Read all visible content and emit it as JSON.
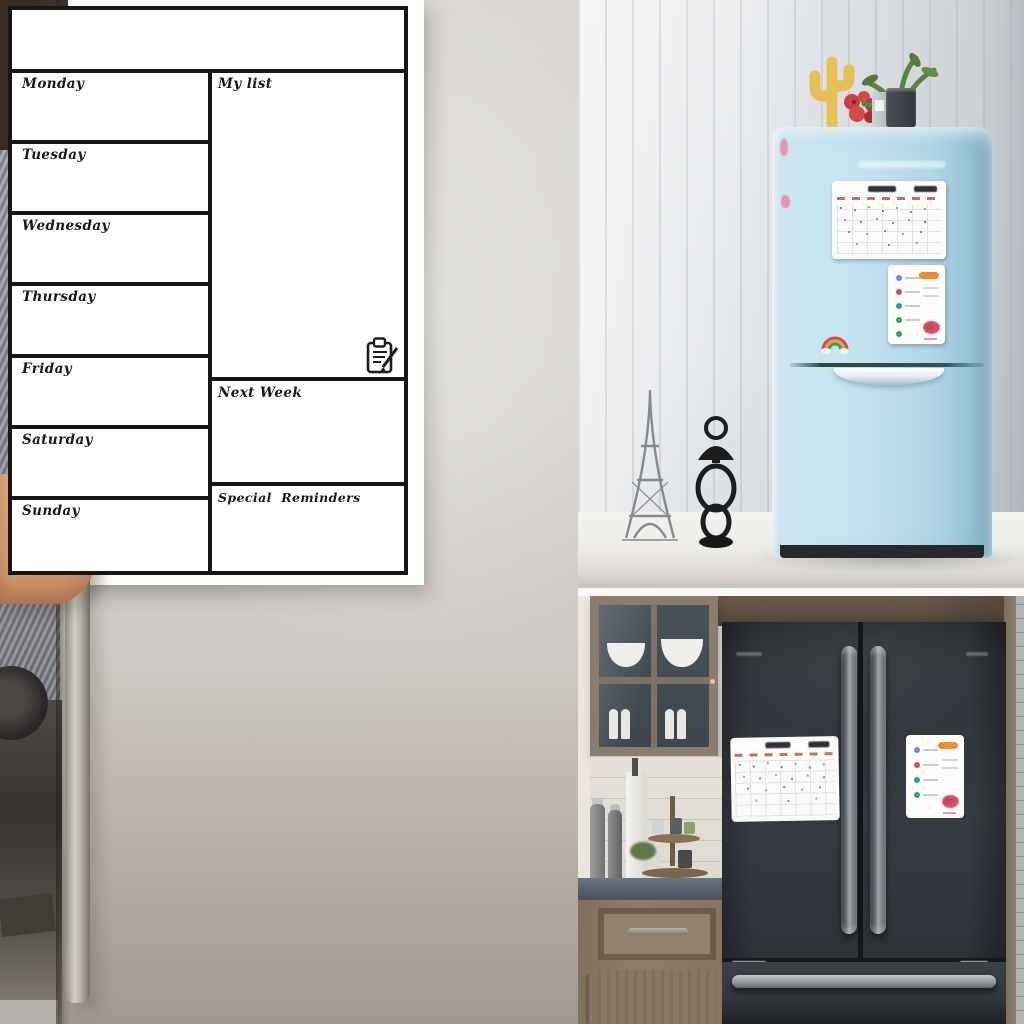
{
  "planner": {
    "days": [
      "Monday",
      "Tuesday",
      "Wednesday",
      "Thursday",
      "Friday",
      "Saturday",
      "Sunday"
    ],
    "my_list_label": "My list",
    "next_week_label": "Next Week",
    "special_reminders_label": "Special  Reminders",
    "header_note": "",
    "icon": "clipboard-pencil-icon"
  },
  "colors": {
    "planner_frame": "#161616",
    "planner_board": "#ffffff",
    "blue_fridge": "#bcdeed",
    "dark_fridge": "#32373d",
    "wood_cabinet": "#87755f",
    "magnet_accent_orange": "#ee8c2e",
    "magnet_accent_red": "#cf6a6a"
  }
}
